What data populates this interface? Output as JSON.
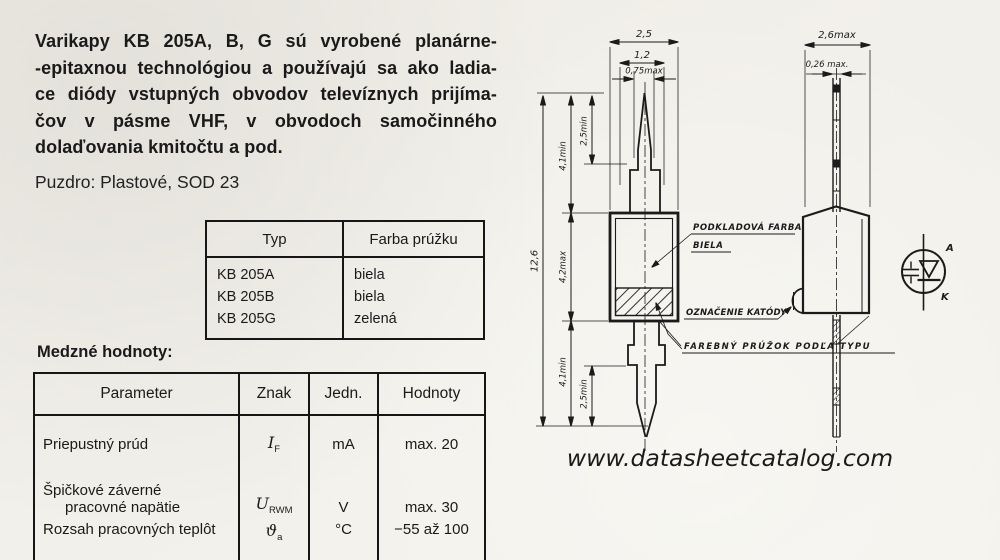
{
  "intro": {
    "lines": [
      "Varikapy KB 205A, B, G sú vyrobené planárne-",
      "-epitaxnou technológiou a používajú sa ako ladia-",
      "ce diódy vstupných obvodov televíznych prijíma-",
      "čov v pásme VHF, v obvodoch samočinného",
      "dolaďovania kmitočtu a pod."
    ],
    "package": "Puzdro: Plastové, SOD 23"
  },
  "type_table": {
    "headers": {
      "typ": "Typ",
      "farba": "Farba prúžku"
    },
    "rows": [
      {
        "typ": "KB 205A",
        "farba": "biela"
      },
      {
        "typ": "KB 205B",
        "farba": "biela"
      },
      {
        "typ": "KB 205G",
        "farba": "zelená"
      }
    ]
  },
  "limits": {
    "title": "Medzné hodnoty:",
    "headers": {
      "parameter": "Parameter",
      "znak": "Znak",
      "jedn": "Jedn.",
      "hodnoty": "Hodnoty"
    },
    "rows": [
      {
        "parameter": "Priepustný prúd",
        "symbol": "I",
        "symbol_sub": "F",
        "unit": "mA",
        "value": "max. 20"
      },
      {
        "parameter_line1": "Špičkové záverné",
        "parameter_line2": "pracovné napätie",
        "symbol": "U",
        "symbol_sub": "RWM",
        "unit": "V",
        "value": "max. 30"
      },
      {
        "parameter": "Rozsah pracovných teplôt",
        "symbol": "ϑ",
        "symbol_sub": "a",
        "unit": "°C",
        "value": "−55 až 100"
      }
    ]
  },
  "drawing": {
    "front": {
      "w_body": "2,5",
      "w_collar": "1,2",
      "w_lead": "0,75max",
      "h_total": "12,6",
      "h_lead_top": "4,1min",
      "h_tip_top": "2,5min",
      "h_body": "4,2max",
      "h_lead_bot": "4,1min",
      "h_tip_bot": "2,5min"
    },
    "side": {
      "w_body": "2,6max",
      "w_lead": "0,26 max."
    },
    "callouts": {
      "base_color_line1": "PODKLADOVÁ FARBA",
      "base_color_line2": "BIELA",
      "cathode_mark": "OZNAČENIE KATÓDY",
      "stripe": "FAREBNÝ PRÚŽOK PODĽA TYPU"
    },
    "symbol": {
      "anode": "A",
      "cathode": "K"
    }
  },
  "watermark": "www.datasheetcatalog.com"
}
